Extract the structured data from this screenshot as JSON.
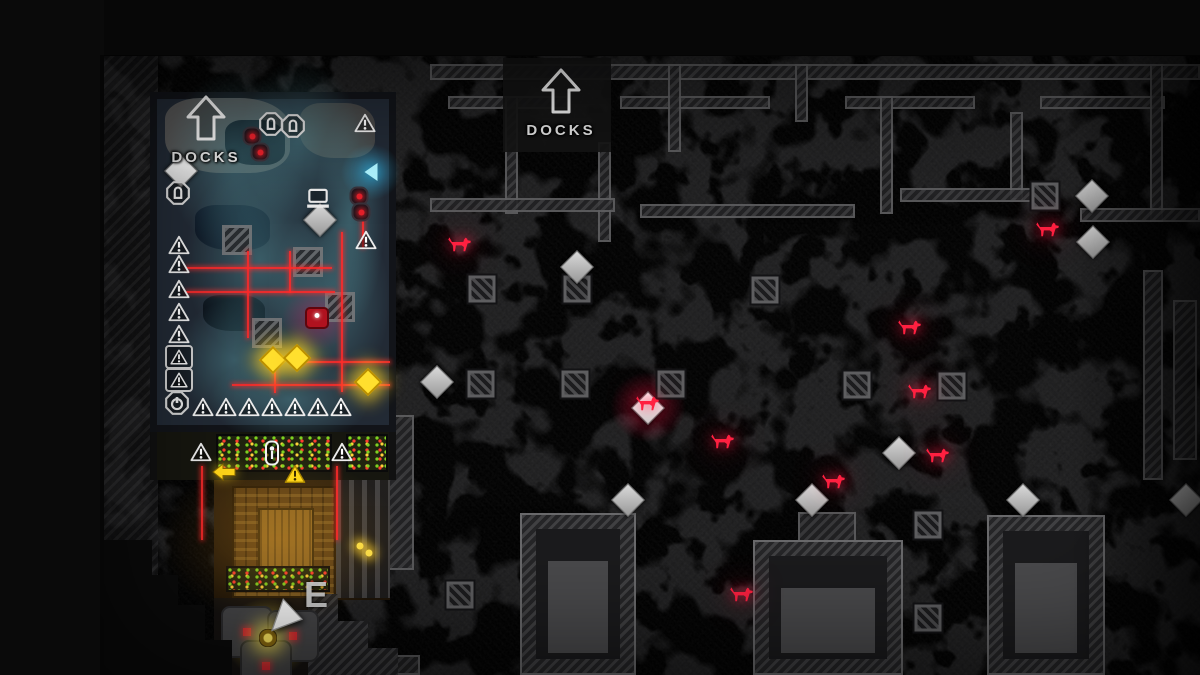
{
  "scene": {
    "exits": [
      {
        "x": 206,
        "y": 95,
        "text": "DOCKS"
      },
      {
        "x": 561,
        "y": 68,
        "text": "DOCKS"
      }
    ],
    "ground_letters": [
      {
        "x": 316,
        "y": 595,
        "text": "E"
      }
    ]
  },
  "colors": {
    "laser": "#ff2a2a",
    "coin": "#ffdf2e",
    "dog": "#ff2040",
    "teal_fog": "#528e98",
    "label_text": "#e2e2e2",
    "map_base": "#1e1e1f",
    "rock_blob": "#4d4d4f"
  },
  "markers": {
    "diamonds": [
      {
        "x": 181,
        "y": 171,
        "cls": "bright"
      },
      {
        "x": 320,
        "y": 220
      },
      {
        "x": 577,
        "y": 267
      },
      {
        "x": 437,
        "y": 382
      },
      {
        "x": 628,
        "y": 500
      },
      {
        "x": 812,
        "y": 500
      },
      {
        "x": 899,
        "y": 453
      },
      {
        "x": 1023,
        "y": 500
      },
      {
        "x": 1186,
        "y": 500
      },
      {
        "x": 1092,
        "y": 196
      },
      {
        "x": 1093,
        "y": 242
      }
    ],
    "special_loot": [
      {
        "x": 648,
        "y": 407
      }
    ],
    "dogs": [
      {
        "x": 460,
        "y": 245
      },
      {
        "x": 1048,
        "y": 230
      },
      {
        "x": 910,
        "y": 328
      },
      {
        "x": 920,
        "y": 392
      },
      {
        "x": 723,
        "y": 442
      },
      {
        "x": 834,
        "y": 482
      },
      {
        "x": 938,
        "y": 456
      },
      {
        "x": 742,
        "y": 595
      }
    ],
    "vents": [
      {
        "x": 482,
        "y": 289
      },
      {
        "x": 577,
        "y": 289
      },
      {
        "x": 575,
        "y": 384
      },
      {
        "x": 481,
        "y": 384
      },
      {
        "x": 857,
        "y": 385
      },
      {
        "x": 952,
        "y": 386
      },
      {
        "x": 1045,
        "y": 196
      },
      {
        "x": 928,
        "y": 525
      },
      {
        "x": 928,
        "y": 618
      },
      {
        "x": 765,
        "y": 290
      },
      {
        "x": 460,
        "y": 595
      },
      {
        "x": 671,
        "y": 384
      }
    ],
    "windows": [
      {
        "x": 237,
        "y": 240
      },
      {
        "x": 308,
        "y": 262
      },
      {
        "x": 340,
        "y": 307
      },
      {
        "x": 267,
        "y": 333
      }
    ],
    "coins": [
      {
        "x": 273,
        "y": 360
      },
      {
        "x": 297,
        "y": 358
      },
      {
        "x": 368,
        "y": 382
      }
    ],
    "small_lights": [
      {
        "x": 360,
        "y": 546
      },
      {
        "x": 369,
        "y": 553
      }
    ],
    "triangles": [
      {
        "x": 179,
        "y": 245
      },
      {
        "x": 179,
        "y": 264
      },
      {
        "x": 179,
        "y": 289
      },
      {
        "x": 179,
        "y": 312
      },
      {
        "x": 179,
        "y": 334
      },
      {
        "x": 203,
        "y": 407
      },
      {
        "x": 226,
        "y": 407
      },
      {
        "x": 249,
        "y": 407
      },
      {
        "x": 272,
        "y": 407
      },
      {
        "x": 295,
        "y": 407
      },
      {
        "x": 318,
        "y": 407
      },
      {
        "x": 341,
        "y": 407
      },
      {
        "x": 365,
        "y": 123
      },
      {
        "x": 366,
        "y": 240
      },
      {
        "x": 201,
        "y": 452
      },
      {
        "x": 342,
        "y": 452
      }
    ],
    "boxed_triangles": [
      {
        "x": 179,
        "y": 357
      },
      {
        "x": 179,
        "y": 380
      }
    ],
    "yellow_triangles": [
      {
        "x": 295,
        "y": 474
      }
    ],
    "yellow_arrows": [
      {
        "x": 224,
        "y": 472
      }
    ],
    "hex_locks": [
      {
        "x": 178,
        "y": 193
      },
      {
        "x": 271,
        "y": 124
      },
      {
        "x": 293,
        "y": 126
      }
    ],
    "power_switches": [
      {
        "x": 177,
        "y": 403
      }
    ],
    "zipper_locks": [
      {
        "x": 272,
        "y": 453
      }
    ],
    "laptops": [
      {
        "x": 318,
        "y": 198
      }
    ],
    "chevrons": [
      {
        "x": 371,
        "y": 172
      }
    ],
    "turrets": [
      {
        "x": 252,
        "y": 136
      },
      {
        "x": 260,
        "y": 152
      },
      {
        "x": 359,
        "y": 196
      },
      {
        "x": 361,
        "y": 212
      }
    ],
    "guards": [
      {
        "x": 317,
        "y": 318
      }
    ],
    "players": [
      {
        "x": 268,
        "y": 638
      }
    ],
    "cursors": [
      {
        "x": 287,
        "y": 613
      }
    ],
    "engines": [
      {
        "x": 247,
        "y": 632
      },
      {
        "x": 293,
        "y": 636
      },
      {
        "x": 266,
        "y": 666
      }
    ]
  },
  "lasers": [
    {
      "x": 186,
      "y": 267,
      "w": 146,
      "h": 2
    },
    {
      "x": 186,
      "y": 291,
      "w": 149,
      "h": 2
    },
    {
      "x": 300,
      "y": 361,
      "w": 90,
      "h": 2
    },
    {
      "x": 232,
      "y": 384,
      "w": 158,
      "h": 2
    },
    {
      "x": 247,
      "y": 251,
      "w": 2,
      "h": 87
    },
    {
      "x": 341,
      "y": 232,
      "w": 2,
      "h": 160
    },
    {
      "x": 289,
      "y": 251,
      "w": 2,
      "h": 42
    },
    {
      "x": 274,
      "y": 356,
      "w": 2,
      "h": 37
    },
    {
      "x": 362,
      "y": 212,
      "w": 2,
      "h": 36
    },
    {
      "x": 201,
      "y": 466,
      "w": 2,
      "h": 74
    },
    {
      "x": 336,
      "y": 466,
      "w": 2,
      "h": 74
    }
  ],
  "walls": [
    {
      "x": 430,
      "y": 64,
      "w": 770,
      "h": 16
    },
    {
      "x": 448,
      "y": 96,
      "w": 120,
      "h": 13
    },
    {
      "x": 620,
      "y": 96,
      "w": 150,
      "h": 13
    },
    {
      "x": 845,
      "y": 96,
      "w": 130,
      "h": 13
    },
    {
      "x": 1040,
      "y": 96,
      "w": 125,
      "h": 13
    },
    {
      "x": 505,
      "y": 96,
      "w": 13,
      "h": 118
    },
    {
      "x": 598,
      "y": 142,
      "w": 13,
      "h": 100
    },
    {
      "x": 668,
      "y": 64,
      "w": 13,
      "h": 88
    },
    {
      "x": 795,
      "y": 64,
      "w": 13,
      "h": 58
    },
    {
      "x": 880,
      "y": 96,
      "w": 13,
      "h": 118
    },
    {
      "x": 1010,
      "y": 112,
      "w": 13,
      "h": 88
    },
    {
      "x": 1150,
      "y": 64,
      "w": 13,
      "h": 158
    },
    {
      "x": 430,
      "y": 198,
      "w": 185,
      "h": 14
    },
    {
      "x": 640,
      "y": 204,
      "w": 215,
      "h": 14
    },
    {
      "x": 900,
      "y": 188,
      "w": 160,
      "h": 14
    },
    {
      "x": 1080,
      "y": 208,
      "w": 120,
      "h": 14
    },
    {
      "x": 798,
      "y": 512,
      "w": 58,
      "h": 30
    },
    {
      "x": 1143,
      "y": 270,
      "w": 20,
      "h": 210
    },
    {
      "x": 1173,
      "y": 300,
      "w": 24,
      "h": 160
    },
    {
      "x": 230,
      "y": 655,
      "w": 190,
      "h": 20
    },
    {
      "x": 388,
      "y": 415,
      "w": 26,
      "h": 155
    }
  ],
  "buildings": [
    {
      "x": 520,
      "y": 513,
      "w": 116,
      "h": 162
    },
    {
      "x": 753,
      "y": 540,
      "w": 150,
      "h": 135
    },
    {
      "x": 987,
      "y": 515,
      "w": 118,
      "h": 160
    }
  ],
  "fog": [
    {
      "x": 235,
      "y": 160,
      "w": 140,
      "h": 180
    },
    {
      "x": 300,
      "y": 140,
      "w": 120,
      "h": 160
    },
    {
      "x": 260,
      "y": 260,
      "w": 150,
      "h": 200
    },
    {
      "x": 330,
      "y": 300,
      "w": 120,
      "h": 190
    },
    {
      "x": 235,
      "y": 360,
      "w": 120,
      "h": 120
    },
    {
      "x": 350,
      "y": 215,
      "w": 70,
      "h": 220
    },
    {
      "x": 290,
      "y": 400,
      "w": 160,
      "h": 90
    }
  ],
  "floor_patches": [
    {
      "x": 165,
      "y": 98,
      "w": 125,
      "h": 75,
      "cls": "p-gray"
    },
    {
      "x": 300,
      "y": 103,
      "w": 75,
      "h": 55,
      "cls": "p-gray2"
    },
    {
      "x": 195,
      "y": 205,
      "w": 75,
      "h": 45,
      "cls": "p-navy"
    },
    {
      "x": 203,
      "y": 295,
      "w": 62,
      "h": 36,
      "cls": "p-navy2"
    },
    {
      "x": 225,
      "y": 120,
      "w": 60,
      "h": 45,
      "cls": "p-navy2"
    }
  ]
}
